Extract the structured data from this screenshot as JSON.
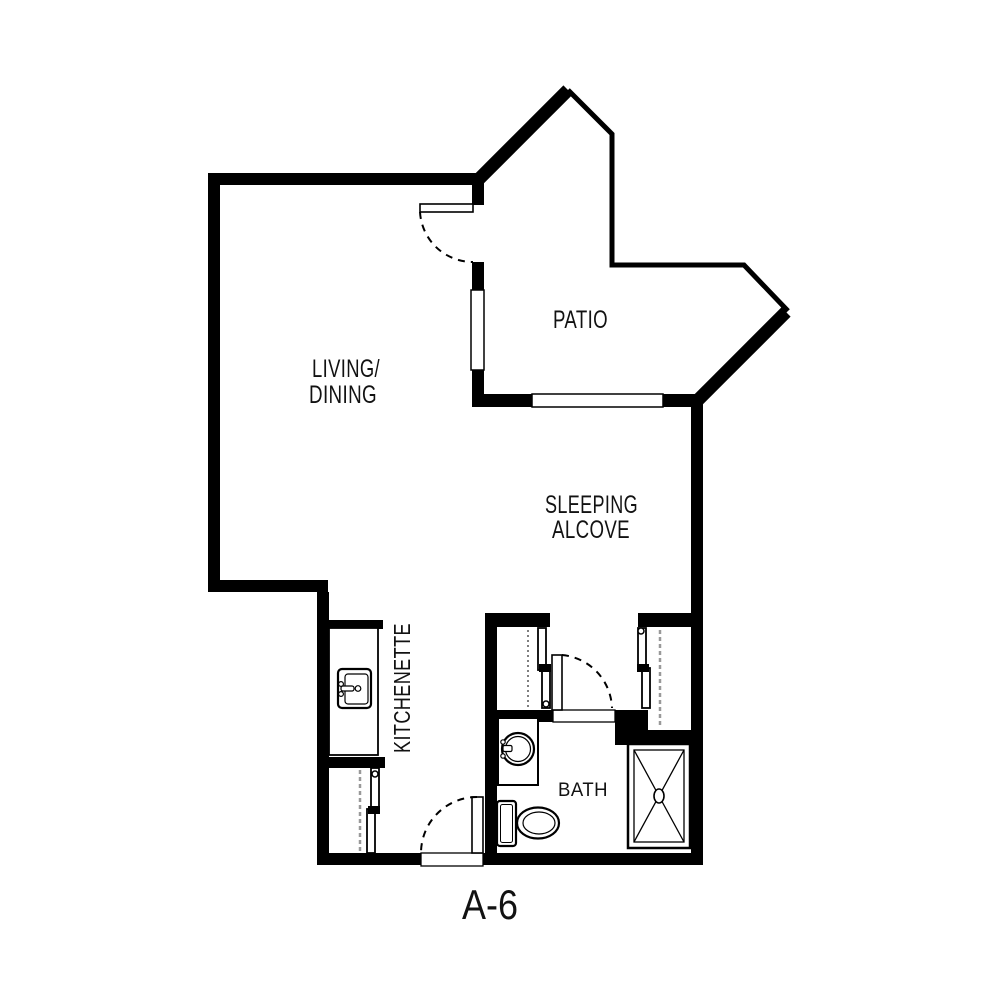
{
  "plan": {
    "unit_label": "A-6",
    "labels": {
      "living_line1": "LIVING/",
      "living_line2": "DINING",
      "patio": "PATIO",
      "sleeping_line1": "SLEEPING",
      "sleeping_line2": "ALCOVE",
      "kitchenette": "KITCHENETTE",
      "bath": "BATH"
    },
    "colors": {
      "background": "#ffffff",
      "walls": "#000000",
      "text": "#121212",
      "closet_rod_dash": "#999999"
    },
    "fixtures": [
      "kitchen-sink",
      "bathroom-sink-vanity",
      "toilet",
      "shower",
      "closet-bypass-doors",
      "swing-doors",
      "windows",
      "patio-railing"
    ]
  }
}
